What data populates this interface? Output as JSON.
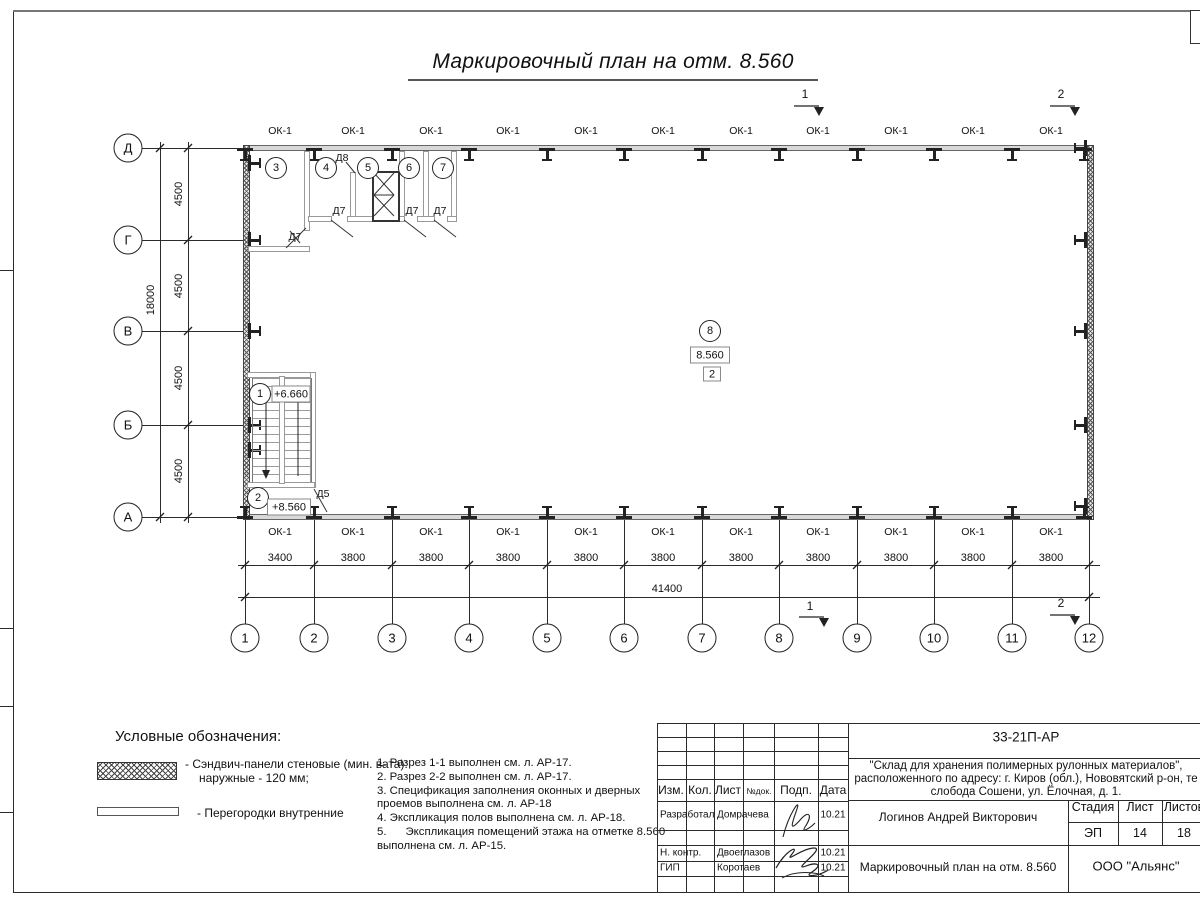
{
  "sheet": {
    "title": "Маркировочный план на отм. 8.560"
  },
  "axes": {
    "rows": [
      "Д",
      "Г",
      "В",
      "Б",
      "А"
    ],
    "cols": [
      "1",
      "2",
      "3",
      "4",
      "5",
      "6",
      "7",
      "8",
      "9",
      "10",
      "11",
      "12"
    ]
  },
  "dims": {
    "h_first": "3400",
    "h_rest": "3800",
    "h_total": "41400",
    "v_seg": "4500",
    "v_total": "18000"
  },
  "windows": {
    "label": "ОК-1"
  },
  "rooms": {
    "n1": "1",
    "n2": "2",
    "n3": "3",
    "n4": "4",
    "n5": "5",
    "n6": "6",
    "n7": "7",
    "n8": "8"
  },
  "marks": {
    "elev_stair_upper": "+6.660",
    "elev_stair_lower": "+8.560",
    "elev_floor": "8.560",
    "floor_box": "2",
    "door_d5": "Д5",
    "door_d7": "Д7",
    "door_d8": "Д8",
    "section1": "1",
    "section2": "2"
  },
  "legend": {
    "heading": "Условные обозначения:",
    "item1_line1": "- Сэндвич-панели стеновые (мин. вата):",
    "item1_line2": "наружные - 120 мм;",
    "item2": "- Перегородки внутренние"
  },
  "notes": {
    "n1": "1. Разрез 1-1 выполнен см. л. АР-17.",
    "n2": "2. Разрез 2-2 выполнен см. л. АР-17.",
    "n3": "3. Спецификация заполнения оконных и дверных проемов выполнена см. л. АР-18",
    "n4": "4. Экспликация полов выполнена см. л. АР-18.",
    "n5": "5.      Экспликация помещений этажа на отметке 8.560 выполнена см. л. АР-15."
  },
  "stamp": {
    "code": "33-21П-АР",
    "project_line1": "\"Склад для хранения полимерных рулонных материалов\",",
    "project_line2": "расположенного по адресу: г. Киров (обл.), Нововятский р-он, те",
    "project_line3": "слобода Сошени, ул. Ёлочная, д. 1.",
    "cols": {
      "izm": "Изм.",
      "kol": "Кол.",
      "list": "Лист",
      "ndoc": "№док.",
      "podp": "Подп.",
      "data": "Дата"
    },
    "row1_role": "Разработал",
    "row1_name": "Домрачева",
    "row1_date": "10.21",
    "row2_role": "Н. контр.",
    "row2_name": "Двоеглазов",
    "row2_date": "10.21",
    "row3_role": "ГИП",
    "row3_name": "Коротаев",
    "row3_date": "10.21",
    "author": "Логинов Андрей Викторович",
    "stage_label": "Стадия",
    "sheet_label": "Лист",
    "sheets_label": "Листов",
    "stage": "ЭП",
    "sheet_no": "14",
    "sheets_total": "18",
    "doc_title": "Маркировочный план на отм. 8.560",
    "company": "ООО \"Альянс\""
  }
}
